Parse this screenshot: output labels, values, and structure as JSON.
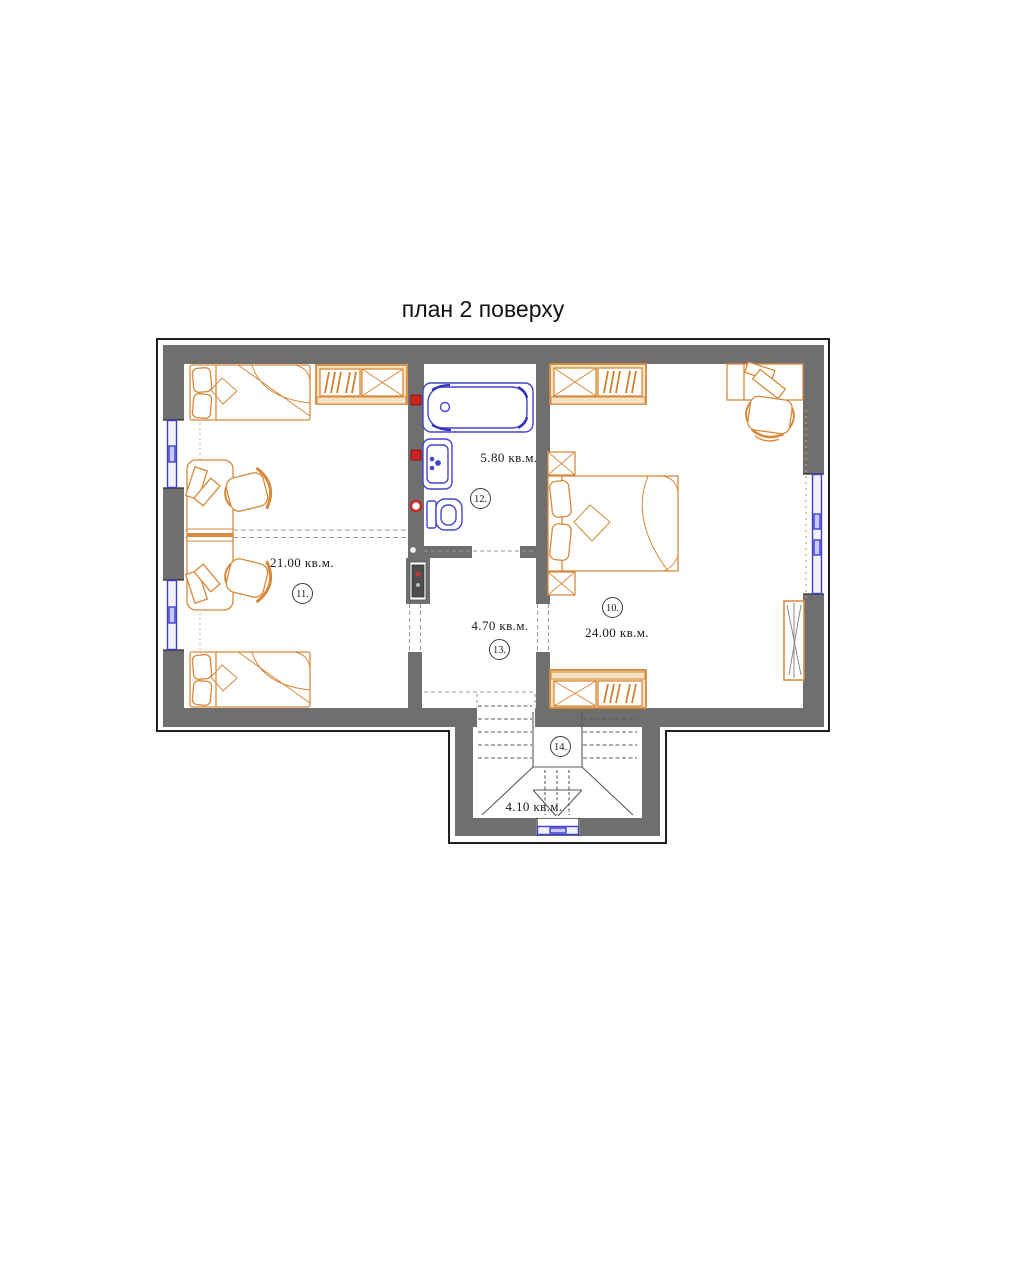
{
  "title": "план 2 поверху",
  "rooms": {
    "bedroom_right": {
      "number": "10.",
      "area": "24.00 кв.м."
    },
    "bedroom_left": {
      "number": "11.",
      "area": "21.00 кв.м."
    },
    "bathroom": {
      "number": "12.",
      "area": "5.80 кв.м."
    },
    "hall": {
      "number": "13.",
      "area": "4.70 кв.м."
    },
    "stairs": {
      "number": "14.",
      "area": "4.10 кв.м."
    }
  },
  "colors": {
    "background": "#ffffff",
    "wall_fill": "#6f6f6f",
    "outline": "#1f1f1f",
    "furniture_stroke": "#d8893b",
    "furniture_frame_fill": "#f6e3c4",
    "plumbing_blue": "#4444cc",
    "window_blue": "#3e3ecf",
    "valve_red": "#cc2222",
    "dash_gray": "#9a9a9a",
    "text": "#1a1a1a"
  }
}
